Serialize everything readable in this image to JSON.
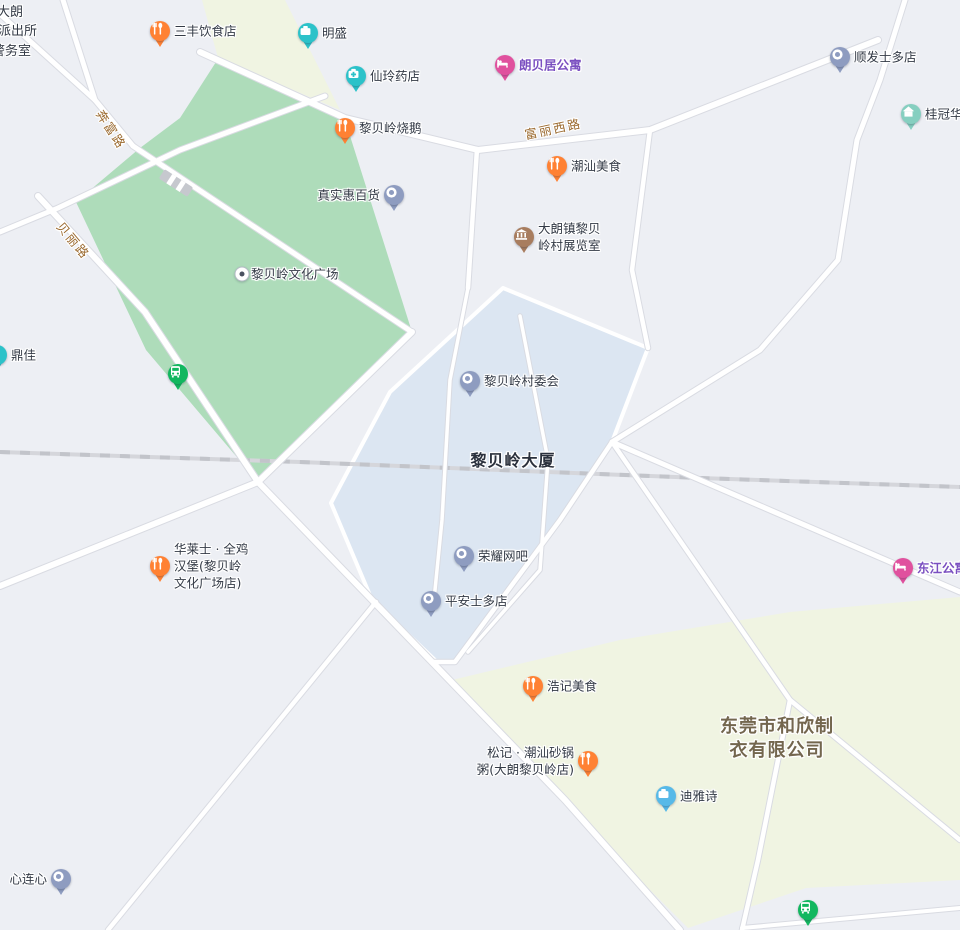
{
  "canvas": {
    "width": 960,
    "height": 930
  },
  "colors": {
    "background": "#edeff4",
    "park": "#aedcba",
    "cream": "#f0f4e2",
    "blue_area": "#dce6f2",
    "road_fill": "#ffffff",
    "road_casing": "#d9dbe2",
    "railway": "#d5d6db",
    "railway_dash": "#c2c4ca",
    "poi_label": "#333a46",
    "road_label": "#9b6a2f",
    "purple_label": "#7a4fc0",
    "area_label": "#2b313d",
    "company_label": "#73664e",
    "pin_food": "#ff8133",
    "pin_shop": "#2cc2c9",
    "pin_pharmacy": "#2cc2c9",
    "pin_hotel": "#e0519e",
    "pin_generic": "#8e9cc0",
    "pin_museum": "#a87d5f",
    "pin_house": "#86cfc0",
    "pin_bus": "#12b75f",
    "pin_company_light": "#57b9e8"
  },
  "areas": [
    {
      "id": "park-libeiling-culture-square",
      "color": "park",
      "points": [
        [
          216,
          62
        ],
        [
          345,
          120
        ],
        [
          412,
          332
        ],
        [
          258,
          482
        ],
        [
          146,
          350
        ],
        [
          76,
          202
        ],
        [
          140,
          148
        ],
        [
          180,
          118
        ]
      ]
    },
    {
      "id": "cream-block-north",
      "color": "cream",
      "points": [
        [
          202,
          0
        ],
        [
          285,
          0
        ],
        [
          340,
          110
        ],
        [
          218,
          58
        ]
      ]
    },
    {
      "id": "blue-block-libeiling-dasha",
      "color": "blue_area",
      "stroke": true,
      "points": [
        [
          503,
          288
        ],
        [
          648,
          348
        ],
        [
          612,
          442
        ],
        [
          560,
          520
        ],
        [
          455,
          662
        ],
        [
          437,
          662
        ],
        [
          372,
          600
        ],
        [
          331,
          503
        ],
        [
          390,
          392
        ]
      ]
    },
    {
      "id": "cream-block-south",
      "color": "cream",
      "points": [
        [
          452,
          680
        ],
        [
          620,
          640
        ],
        [
          790,
          612
        ],
        [
          960,
          597
        ],
        [
          960,
          880
        ],
        [
          806,
          888
        ],
        [
          688,
          928
        ],
        [
          560,
          800
        ]
      ]
    }
  ],
  "railway": {
    "id": "railway-line",
    "points": [
      [
        0,
        452
      ],
      [
        300,
        462
      ],
      [
        700,
        478
      ],
      [
        960,
        487
      ]
    ]
  },
  "bridge": {
    "x": 176,
    "y": 183,
    "angle": 33
  },
  "roads": [
    {
      "id": "benfu-road",
      "w": 5,
      "pts": [
        [
          63,
          0
        ],
        [
          95,
          100
        ],
        [
          133,
          146
        ]
      ]
    },
    {
      "id": "northwest-stub-road",
      "w": 5,
      "pts": [
        [
          0,
          14
        ],
        [
          95,
          100
        ]
      ]
    },
    {
      "id": "park-northwest-road",
      "w": 5,
      "pts": [
        [
          325,
          96
        ],
        [
          180,
          150
        ],
        [
          58,
          208
        ],
        [
          0,
          232
        ]
      ]
    },
    {
      "id": "beili-road",
      "w": 6,
      "pts": [
        [
          38,
          196
        ],
        [
          145,
          312
        ],
        [
          258,
          482
        ],
        [
          432,
          662
        ],
        [
          565,
          800
        ],
        [
          680,
          930
        ]
      ]
    },
    {
      "id": "park-diagonal-road",
      "w": 5,
      "pts": [
        [
          133,
          146
        ],
        [
          412,
          332
        ]
      ]
    },
    {
      "id": "cross-road-sw",
      "w": 6,
      "pts": [
        [
          412,
          332
        ],
        [
          258,
          482
        ],
        [
          0,
          586
        ]
      ]
    },
    {
      "id": "fuli-west-road",
      "w": 6,
      "pts": [
        [
          200,
          52
        ],
        [
          345,
          118
        ],
        [
          478,
          150
        ],
        [
          650,
          130
        ],
        [
          878,
          40
        ]
      ]
    },
    {
      "id": "branch-road-470",
      "w": 4.5,
      "pts": [
        [
          477,
          149
        ],
        [
          468,
          288
        ]
      ]
    },
    {
      "id": "branch-road-640",
      "w": 4.5,
      "pts": [
        [
          650,
          130
        ],
        [
          632,
          270
        ],
        [
          648,
          348
        ]
      ]
    },
    {
      "id": "northeast-curve-road",
      "w": 5,
      "pts": [
        [
          905,
          0
        ],
        [
          880,
          80
        ],
        [
          857,
          140
        ],
        [
          838,
          260
        ],
        [
          760,
          350
        ],
        [
          612,
          442
        ]
      ]
    },
    {
      "id": "dongjiang-road",
      "w": 5,
      "pts": [
        [
          612,
          442
        ],
        [
          960,
          592
        ]
      ]
    },
    {
      "id": "south-link-road",
      "w": 4.5,
      "pts": [
        [
          612,
          442
        ],
        [
          790,
          700
        ]
      ]
    },
    {
      "id": "south-road-a",
      "w": 4.5,
      "pts": [
        [
          790,
          700
        ],
        [
          758,
          860
        ],
        [
          742,
          930
        ]
      ]
    },
    {
      "id": "south-road-b",
      "w": 4.5,
      "pts": [
        [
          790,
          700
        ],
        [
          960,
          840
        ]
      ]
    },
    {
      "id": "bottom-right-road",
      "w": 4,
      "pts": [
        [
          742,
          928
        ],
        [
          960,
          908
        ]
      ]
    },
    {
      "id": "blue-east-road",
      "w": 4.5,
      "pts": [
        [
          612,
          442
        ],
        [
          560,
          520
        ],
        [
          455,
          662
        ],
        [
          432,
          662
        ]
      ]
    },
    {
      "id": "southwest-road",
      "w": 4.5,
      "pts": [
        [
          108,
          930
        ],
        [
          376,
          602
        ]
      ]
    },
    {
      "id": "inner-path-a",
      "w": 3.5,
      "pts": [
        [
          468,
          288
        ],
        [
          450,
          380
        ],
        [
          442,
          520
        ],
        [
          434,
          600
        ]
      ]
    },
    {
      "id": "inner-path-b",
      "w": 3.5,
      "pts": [
        [
          520,
          316
        ],
        [
          548,
          460
        ],
        [
          540,
          570
        ],
        [
          468,
          652
        ]
      ]
    }
  ],
  "road_labels": [
    {
      "id": "benfu-road-label",
      "text": "奔富路",
      "x": 112,
      "y": 129,
      "angle": 57
    },
    {
      "id": "beili-road-label",
      "text": "贝丽路",
      "x": 74,
      "y": 240,
      "angle": 50
    },
    {
      "id": "fuli-west-road-label",
      "text": "富丽西路",
      "x": 553,
      "y": 128,
      "angle": -12
    }
  ],
  "area_labels": [
    {
      "id": "building-label-libeiling-dasha",
      "lines": [
        "黎贝岭大厦"
      ],
      "x": 513,
      "y": 461,
      "size": 16,
      "line_height": 20,
      "color_key": "area_label",
      "spacing": 1
    },
    {
      "id": "company-label-hexin",
      "lines": [
        "东莞市和欣制",
        "衣有限公司"
      ],
      "x": 777,
      "y": 739,
      "size": 18,
      "line_height": 24,
      "color_key": "company_label",
      "spacing": 1
    }
  ],
  "police_station": {
    "id": "police-station-label",
    "lines": [
      {
        "text": "局大朗",
        "x": -16,
        "y": 1
      },
      {
        "text": "派出所",
        "x": -2,
        "y": 20
      },
      {
        "text": "警务室",
        "x": -8,
        "y": 40
      }
    ]
  },
  "pois": [
    {
      "id": "sanfeng-restaurant",
      "type": "food",
      "x": 160,
      "y": 31,
      "label": [
        "三丰饮食店"
      ],
      "side": "right"
    },
    {
      "id": "mingsheng",
      "type": "shop",
      "x": 308,
      "y": 33,
      "label": [
        "明盛"
      ],
      "side": "right"
    },
    {
      "id": "xianling-pharmacy",
      "type": "pharmacy",
      "x": 356,
      "y": 76,
      "label": [
        "仙玲药店"
      ],
      "side": "right"
    },
    {
      "id": "langbeiju-apartment",
      "type": "hotel",
      "x": 505,
      "y": 65,
      "label": [
        "朗贝居公寓"
      ],
      "side": "right",
      "label_color": "purple_label",
      "bold": true
    },
    {
      "id": "shunfa-store",
      "type": "generic",
      "x": 840,
      "y": 57,
      "label": [
        "顺发士多店"
      ],
      "side": "right"
    },
    {
      "id": "guiguan-huating",
      "type": "house",
      "x": 911,
      "y": 114,
      "label": [
        "桂冠华庭"
      ],
      "side": "right"
    },
    {
      "id": "libeiling-roast-goose",
      "type": "food",
      "x": 345,
      "y": 128,
      "label": [
        "黎贝岭烧鹅"
      ],
      "side": "right"
    },
    {
      "id": "chaoshan-food",
      "type": "food",
      "x": 557,
      "y": 166,
      "label": [
        "潮汕美食"
      ],
      "side": "right"
    },
    {
      "id": "zhenshihui-store",
      "type": "generic",
      "x": 394,
      "y": 195,
      "label": [
        "真实惠百货"
      ],
      "side": "left"
    },
    {
      "id": "village-exhibition-room",
      "type": "museum",
      "x": 524,
      "y": 237,
      "label": [
        "大朗镇黎贝",
        "岭村展览室"
      ],
      "side": "right"
    },
    {
      "id": "culture-square-dot",
      "type": "dot",
      "x": 242,
      "y": 274,
      "label": [
        "黎贝岭文化广场"
      ],
      "side": "right"
    },
    {
      "id": "dingjia",
      "type": "shop",
      "x": -3,
      "y": 355,
      "label": [
        "鼎佳"
      ],
      "side": "right"
    },
    {
      "id": "bus-stop-1",
      "type": "bus",
      "x": 178,
      "y": 374,
      "label": [],
      "side": "right"
    },
    {
      "id": "village-committee",
      "type": "generic",
      "x": 470,
      "y": 381,
      "label": [
        "黎贝岭村委会"
      ],
      "side": "right"
    },
    {
      "id": "rongyao-internet-cafe",
      "type": "generic",
      "x": 464,
      "y": 556,
      "label": [
        "荣耀网吧"
      ],
      "side": "right"
    },
    {
      "id": "pingan-store",
      "type": "generic",
      "x": 431,
      "y": 601,
      "label": [
        "平安士多店"
      ],
      "side": "right"
    },
    {
      "id": "hualaishi-burger",
      "type": "food",
      "x": 160,
      "y": 566,
      "label": [
        "华莱士 · 全鸡",
        "汉堡(黎贝岭",
        "文化广场店)"
      ],
      "side": "right"
    },
    {
      "id": "dongjiang-apartment",
      "type": "hotel",
      "x": 903,
      "y": 568,
      "label": [
        "东江公寓"
      ],
      "side": "right",
      "label_color": "purple_label",
      "bold": true
    },
    {
      "id": "haoji-food",
      "type": "food",
      "x": 533,
      "y": 686,
      "label": [
        "浩记美食"
      ],
      "side": "right"
    },
    {
      "id": "songji-casserole-porridge",
      "type": "food",
      "x": 588,
      "y": 761,
      "label": [
        "松记 · 潮汕砂锅",
        "粥(大朗黎贝岭店)"
      ],
      "side": "left"
    },
    {
      "id": "diyashi",
      "type": "company_light",
      "x": 666,
      "y": 796,
      "label": [
        "迪雅诗"
      ],
      "side": "right"
    },
    {
      "id": "xinlianxin",
      "type": "generic",
      "x": 61,
      "y": 879,
      "label": [
        "心连心"
      ],
      "side": "left"
    },
    {
      "id": "bus-stop-2",
      "type": "bus",
      "x": 808,
      "y": 910,
      "label": [],
      "side": "right"
    }
  ]
}
